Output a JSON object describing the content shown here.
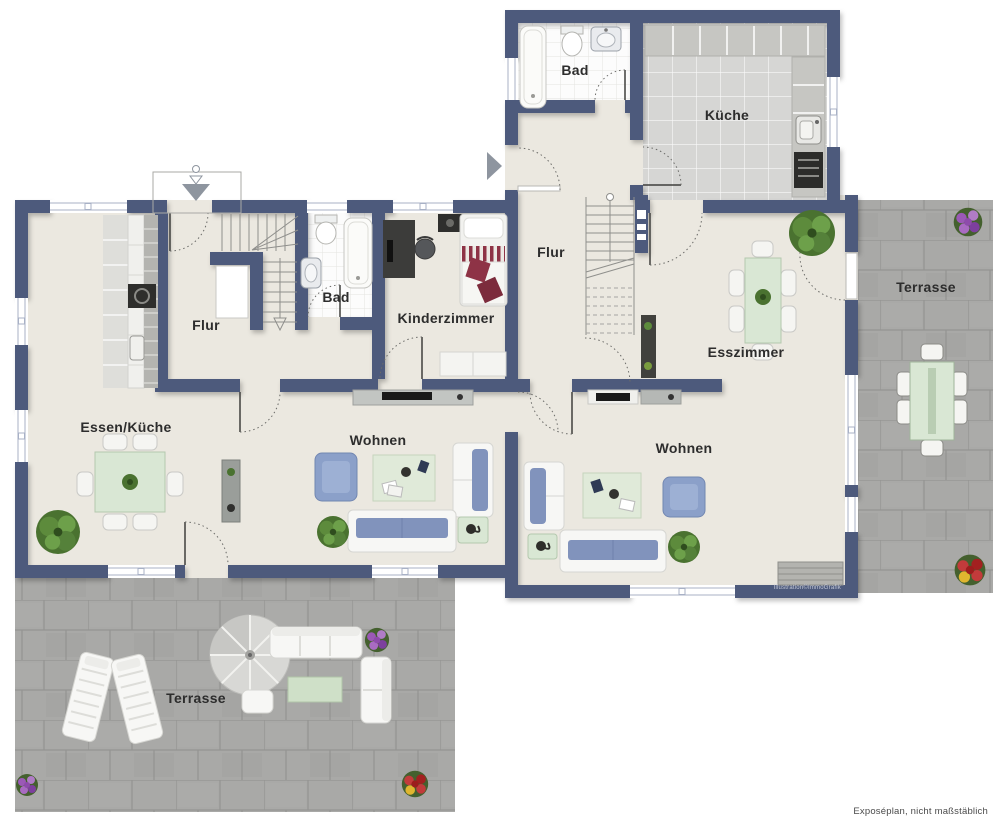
{
  "plan": {
    "footer_note": "Exposéplan, nicht maßstäblich",
    "credit": "Illustration©ImmoGrafik",
    "rooms": [
      {
        "id": "bad-og",
        "label": "Bad",
        "x": 575,
        "y": 70
      },
      {
        "id": "kueche",
        "label": "Küche",
        "x": 727,
        "y": 115
      },
      {
        "id": "flur-rechts",
        "label": "Flur",
        "x": 551,
        "y": 252
      },
      {
        "id": "terrasse-rechts",
        "label": "Terrasse",
        "x": 926,
        "y": 287
      },
      {
        "id": "esszimmer",
        "label": "Esszimmer",
        "x": 746,
        "y": 352
      },
      {
        "id": "flur-links",
        "label": "Flur",
        "x": 206,
        "y": 325
      },
      {
        "id": "bad-links",
        "label": "Bad",
        "x": 336,
        "y": 297
      },
      {
        "id": "kinderzimmer",
        "label": "Kinderzimmer",
        "x": 446,
        "y": 318
      },
      {
        "id": "essen-kueche",
        "label": "Essen/Küche",
        "x": 126,
        "y": 427
      },
      {
        "id": "wohnen-links",
        "label": "Wohnen",
        "x": 378,
        "y": 440
      },
      {
        "id": "wohnen-rechts",
        "label": "Wohnen",
        "x": 684,
        "y": 448
      },
      {
        "id": "terrasse-unten",
        "label": "Terrasse",
        "x": 196,
        "y": 698
      }
    ],
    "icons": {
      "entrance_left": "arrow-down-icon",
      "entrance_upper": "arrow-right-icon"
    },
    "colors": {
      "wall": "#4d5a7b",
      "floor": "#ebe8e0",
      "bath_tile": "#fcfcfc",
      "kitchen_tile": "#d6d6d4",
      "terrace": "#a9a9a7",
      "sofa_blue": "#8193bc",
      "table_green": "#d9e7d4",
      "rug_green": "#e0ead9",
      "bed_red": "#8e3346",
      "plant_green": "#4a7230",
      "label_text": "#2d2d2d"
    }
  }
}
